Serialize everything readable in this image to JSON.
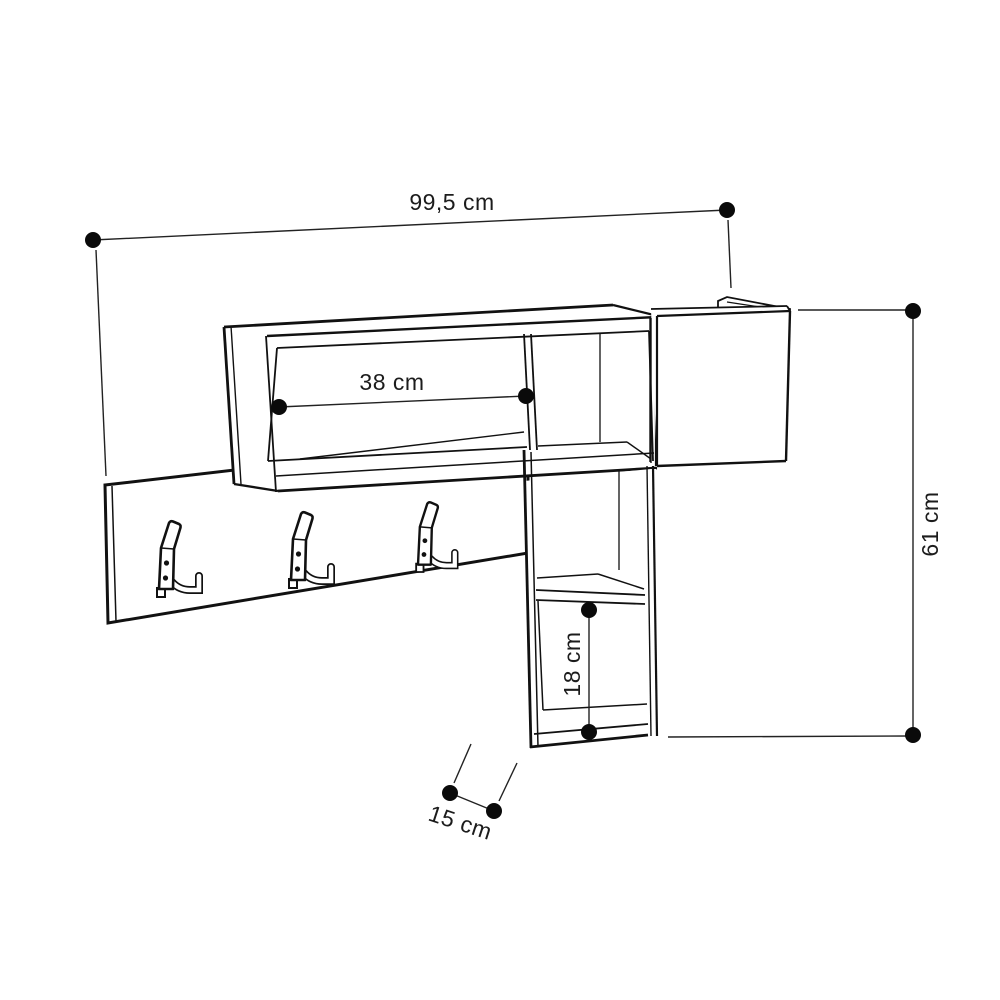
{
  "diagram": {
    "background_color": "#ffffff",
    "line_color": "#111111",
    "hook_count": 3,
    "labels": {
      "overall_width": "99,5 cm",
      "shelf_inner_width": "38 cm",
      "overall_height": "61 cm",
      "lower_compartment_height": "18 cm",
      "depth": "15 cm"
    }
  }
}
